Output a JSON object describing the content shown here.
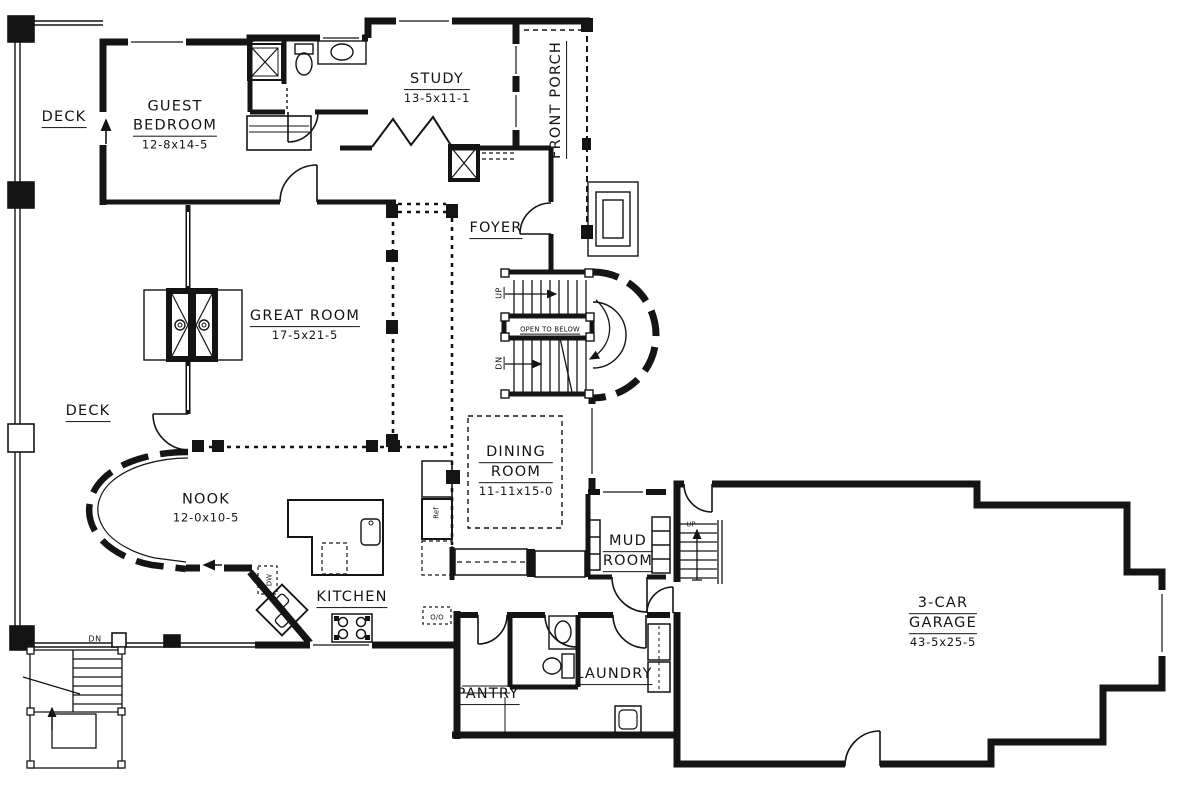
{
  "plan_labels": {
    "deck_upper": {
      "lines": [
        "DECK"
      ]
    },
    "guest_bedroom": {
      "lines": [
        "GUEST",
        "BEDROOM"
      ],
      "dims": "12-8x14-5"
    },
    "study": {
      "lines": [
        "STUDY"
      ],
      "dims": "13-5x11-1"
    },
    "front_porch": {
      "lines": [
        "FRONT PORCH"
      ]
    },
    "foyer": {
      "lines": [
        "FOYER"
      ]
    },
    "great_room": {
      "lines": [
        "GREAT ROOM"
      ],
      "dims": "17-5x21-5"
    },
    "deck_lower": {
      "lines": [
        "DECK"
      ]
    },
    "nook": {
      "lines": [
        "NOOK"
      ],
      "dims": "12-0x10-5"
    },
    "kitchen": {
      "lines": [
        "KITCHEN"
      ]
    },
    "dining_room": {
      "lines": [
        "DINING",
        "ROOM"
      ],
      "dims": "11-11x15-0"
    },
    "mud_room": {
      "lines": [
        "MUD",
        "ROOM"
      ]
    },
    "pantry": {
      "lines": [
        "PANTRY"
      ]
    },
    "laundry": {
      "lines": [
        "LAUNDRY"
      ]
    },
    "garage": {
      "lines": [
        "3-CAR",
        "GARAGE"
      ],
      "dims": "43-5x25-5"
    },
    "open_to_below": {
      "text": "OPEN TO BELOW"
    },
    "stair_up": {
      "text": "UP"
    },
    "stair_dn": {
      "text": "DN"
    },
    "garage_up": {
      "text": "UP"
    },
    "deck_dn": {
      "text": "DN"
    },
    "dishwasher": {
      "text": "DW"
    },
    "refrigerator": {
      "text": "Ref"
    },
    "double_oven": {
      "text": "O/O"
    }
  },
  "colors": {
    "line": "#141414",
    "background": "#ffffff"
  }
}
